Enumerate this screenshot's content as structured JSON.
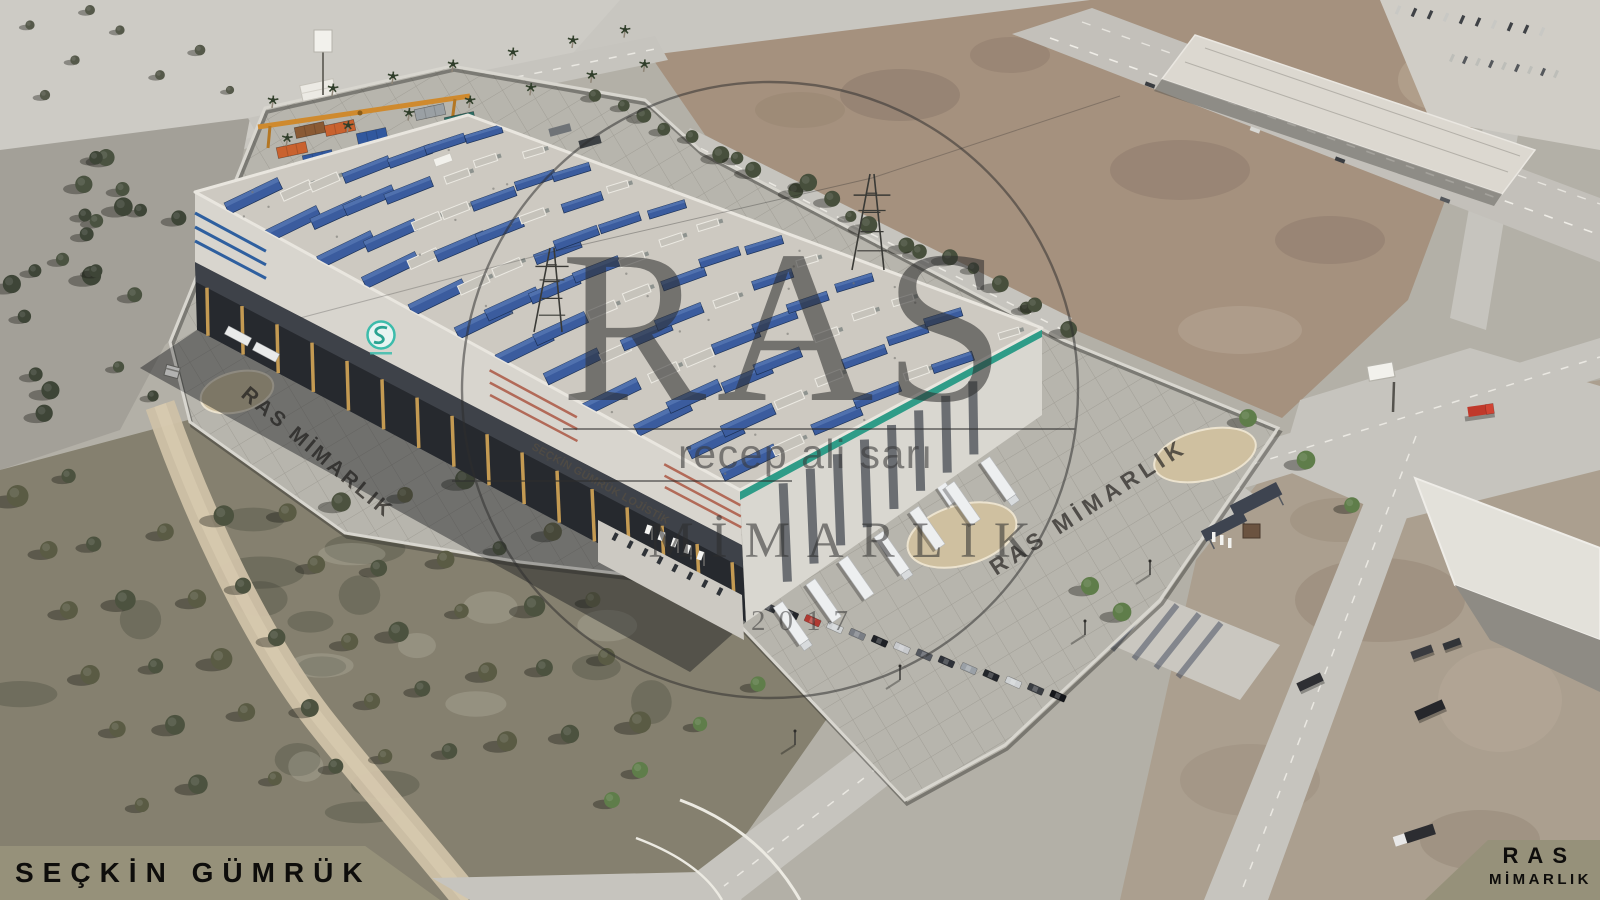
{
  "watermark": {
    "brand": "RAS",
    "architect": "recep ali sarı",
    "discipline": "MİMARLIK",
    "year": "2017"
  },
  "ground_stamps": {
    "left": "RAS MİMARLIK",
    "right": "RAS MİMARLIK"
  },
  "building": {
    "fascia_text": "SEÇKİN GÜMRÜK LOJİSTİK"
  },
  "banner_left": {
    "text": "SEÇKİN GÜMRÜK"
  },
  "banner_right": {
    "line1": "RAS",
    "line2": "MİMARLIK"
  },
  "palette": {
    "banner_bg": "#96917a",
    "banner_text": "#0e0d0b",
    "watermark_ink": "#2e2e2e",
    "terrain_base": "#b3b0a7",
    "terrain_light": "#c8c6c0",
    "field_brown": "#a5917e",
    "grove": "#85806f",
    "pavement": "#b7b5ad",
    "sand": "#cfc0a0",
    "road": "#c6c4be",
    "path_tan": "#cfc1a6",
    "roof": "#cdc9c1",
    "fascia": "#d8d5ce",
    "dock_dark": "#26292e",
    "pillar_gold": "#c49a52",
    "green_stripe": "#2f9c88",
    "stripe_blue": "#2e5f9f",
    "stripe_red": "#b26a58",
    "solar_blue": "#3b5c9e",
    "logo_teal": "#3cbcab",
    "trailer_white": "#edeff0",
    "truck_red": "#c0392b",
    "tree_dark": "#3f4437",
    "tree_green": "#5f7d4a"
  }
}
